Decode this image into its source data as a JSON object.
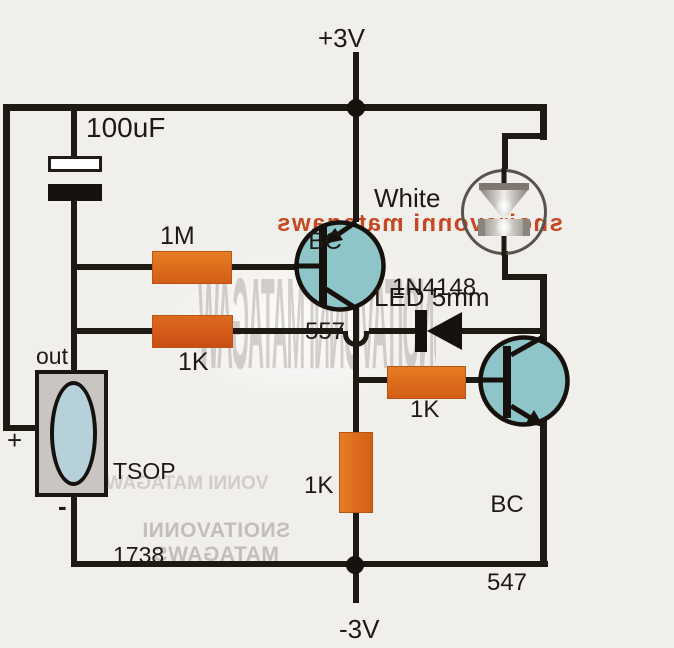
{
  "title": "IR remote controlled white LED circuit schematic",
  "colors": {
    "background": "#f1efec",
    "wire": "#1f1913",
    "resistor_orange": "#dd6e1c",
    "transistor_fill": "#8ec5c8",
    "tsop_body": "#c9c5c1",
    "tsop_lens": "#b7d1da",
    "led_ring": "#57534d",
    "watermark_red": "#c23a0f"
  },
  "power": {
    "positive": "+3V",
    "negative": "-3V"
  },
  "components": {
    "capacitor": {
      "value": "100uF"
    },
    "resistor_1m": {
      "value": "1M"
    },
    "resistor_1k_input": {
      "value": "1K"
    },
    "resistor_1k_base": {
      "value": "1K"
    },
    "resistor_1k_pulldown": {
      "value": "1K"
    },
    "diode": {
      "part": "1N4148"
    },
    "pnp_transistor": {
      "line1": "BC",
      "line2": "557"
    },
    "npn_transistor": {
      "line1": "BC",
      "line2": "547"
    },
    "led": {
      "line1": "White",
      "line2": "LED 5mm"
    },
    "ir_receiver": {
      "line1": "TSOP",
      "line2": "1738",
      "pin_out": "out",
      "pin_plus": "+",
      "pin_minus": "-"
    }
  },
  "watermarks": {
    "red_text": "swagatam innovations",
    "gray_text": "SWAGATAM INNOVATIONS",
    "gray_partial": "WAGATAM INNOV",
    "gray_mid": "SWAGATAM INNOVATIONS"
  }
}
